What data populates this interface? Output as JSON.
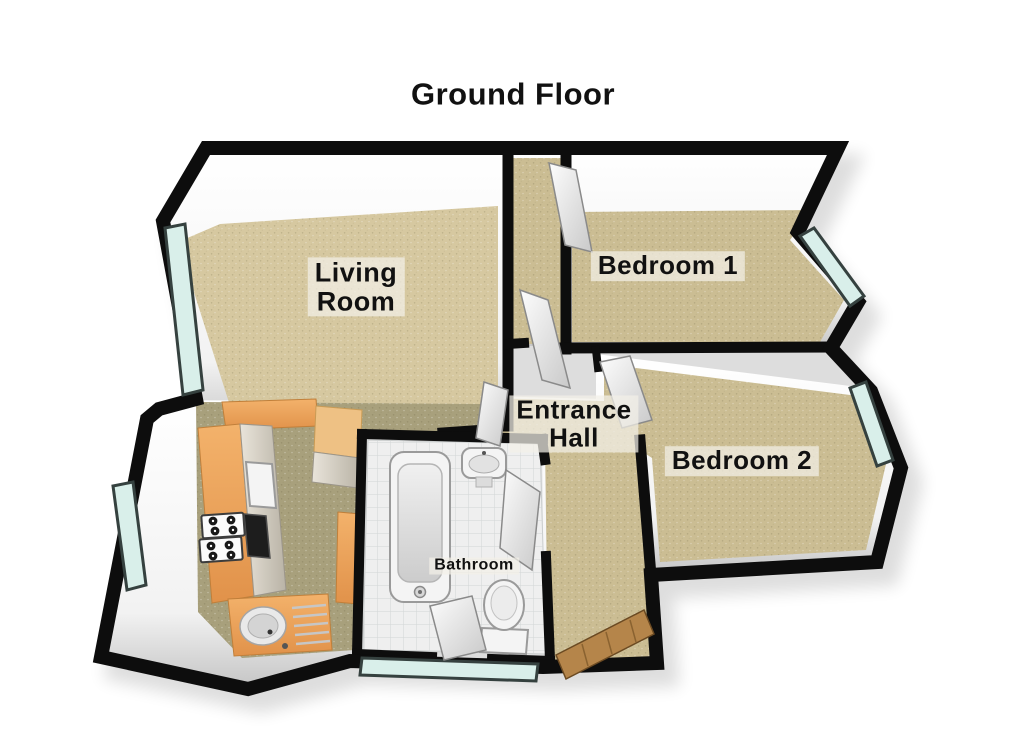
{
  "title": "Ground Floor",
  "rooms": {
    "living_room": {
      "line1": "Living",
      "line2": "Room"
    },
    "bedroom1": {
      "label": "Bedroom 1"
    },
    "bedroom2": {
      "label": "Bedroom 2"
    },
    "entrance_hall": {
      "line1": "Entrance",
      "line2": "Hall"
    },
    "bathroom": {
      "label": "Bathroom"
    }
  },
  "colors": {
    "page_bg": "#ffffff",
    "wall": "#0d0d0d",
    "carpet": "#d6c8a0",
    "carpet_dark": "#cbbd93",
    "kitchen_floor": "#a8a07c",
    "counter": "#efa65c",
    "counter_light": "#eec184",
    "window_glass": "#d9efea",
    "window_frame": "#35413f",
    "tile": "#efefef",
    "tile_line": "#d2d6d6",
    "door_wood": "#b5854a",
    "text": "#111111"
  }
}
